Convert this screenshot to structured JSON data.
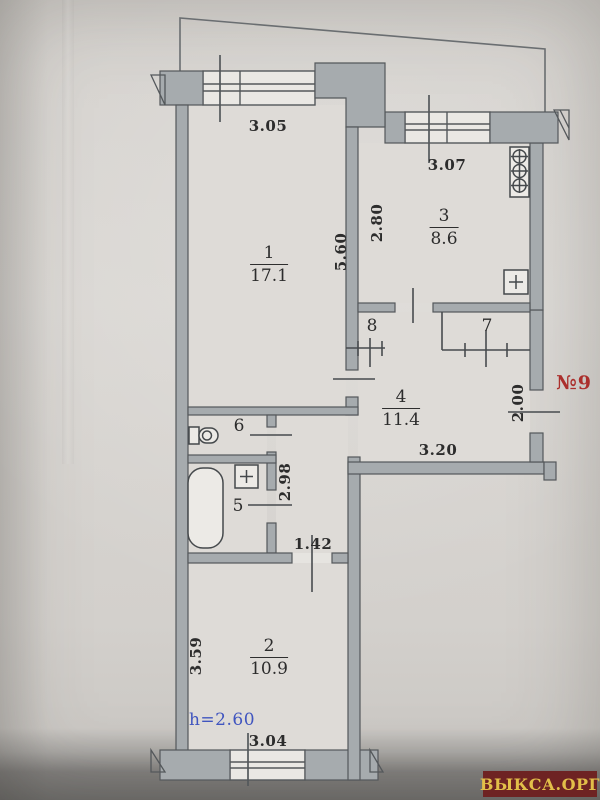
{
  "plan": {
    "unit_label": "№9",
    "height_label": "h=2.60",
    "watermark": "ВЫКСА.ОРГ",
    "rooms": {
      "r1": {
        "num": "1",
        "area": "17.1"
      },
      "r2": {
        "num": "2",
        "area": "10.9"
      },
      "r3": {
        "num": "3",
        "area": "8.6"
      },
      "r4": {
        "num": "4",
        "area": "11.4"
      },
      "r5": {
        "num": "5"
      },
      "r6": {
        "num": "6"
      },
      "r7": {
        "num": "7"
      },
      "r8": {
        "num": "8"
      }
    },
    "dims": {
      "room1_width": "3.05",
      "kitchen_width": "3.07",
      "kitchen_depth": "2.80",
      "room1_depth": "5.60",
      "hall_width": "3.20",
      "entry_opening": "2.00",
      "bath_depth": "2.98",
      "room2_door": "1.42",
      "room2_depth": "3.59",
      "room2_width": "3.04"
    },
    "colors": {
      "paper": "#d7d4d0",
      "wall_fill": "#a6abae",
      "line": "#54585b",
      "text": "#2c2c2c",
      "unit_red": "#ab2f2c",
      "height_blue": "#4055bf",
      "watermark_bg": "#6e2323",
      "watermark_text": "#e2bf49"
    },
    "icons": {
      "stove": "stove-icon",
      "kitchen_sink": "sink-icon",
      "bath_sink": "sink-icon",
      "toilet": "toilet-icon",
      "bathtub": "bathtub-icon"
    }
  }
}
